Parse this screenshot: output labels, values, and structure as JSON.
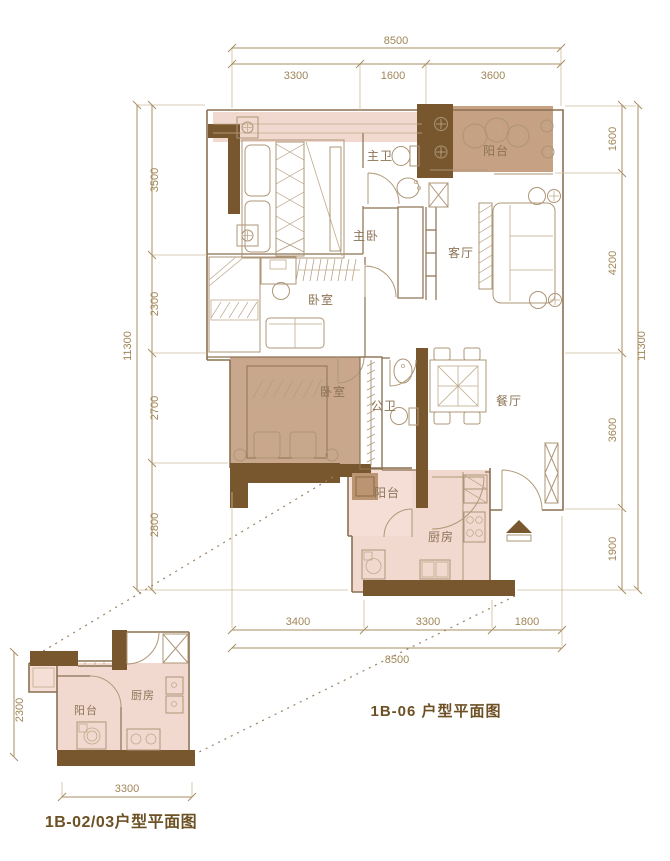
{
  "main_plan": {
    "title": "1B-06 户型平面图",
    "rooms": {
      "master_bedroom": "主卧",
      "master_bath": "主卫",
      "north_balcony": "阳台",
      "living_room": "客厅",
      "bedroom_a": "卧室",
      "bedroom_b": "卧室",
      "guest_bath": "公卫",
      "dining_room": "餐厅",
      "service_balcony": "阳台",
      "kitchen": "厨房"
    },
    "dimensions": {
      "top_total": "8500",
      "top_segments": [
        "3300",
        "1600",
        "3600"
      ],
      "bottom_segments": [
        "3400",
        "3300",
        "1800"
      ],
      "bottom_total": "8500",
      "left_total": "11300",
      "left_segments": [
        "3500",
        "2300",
        "2700",
        "2800"
      ],
      "right_segments": [
        "1600",
        "4200",
        "3600",
        "1900"
      ],
      "right_total": "11300"
    }
  },
  "small_plan": {
    "title": "1B-02/03户型平面图",
    "rooms": {
      "balcony": "阳台",
      "kitchen": "厨房"
    },
    "dimensions": {
      "left": "2300",
      "bottom": "3300"
    }
  },
  "colors": {
    "background": "#ffffff",
    "wall_fill": "#78572f",
    "wall_line": "#8a7052",
    "room_pink": "#f2d9d0",
    "room_pink_light": "#f4ded6",
    "bed_pink": "#eed3c9",
    "balcony_tan": "#c6a183",
    "bedroom_tan": "#c9a78d",
    "washer_tan": "#bb9573",
    "dimension_text": "#a08657",
    "label_text": "#8c7355",
    "title_text": "#6d5124"
  }
}
